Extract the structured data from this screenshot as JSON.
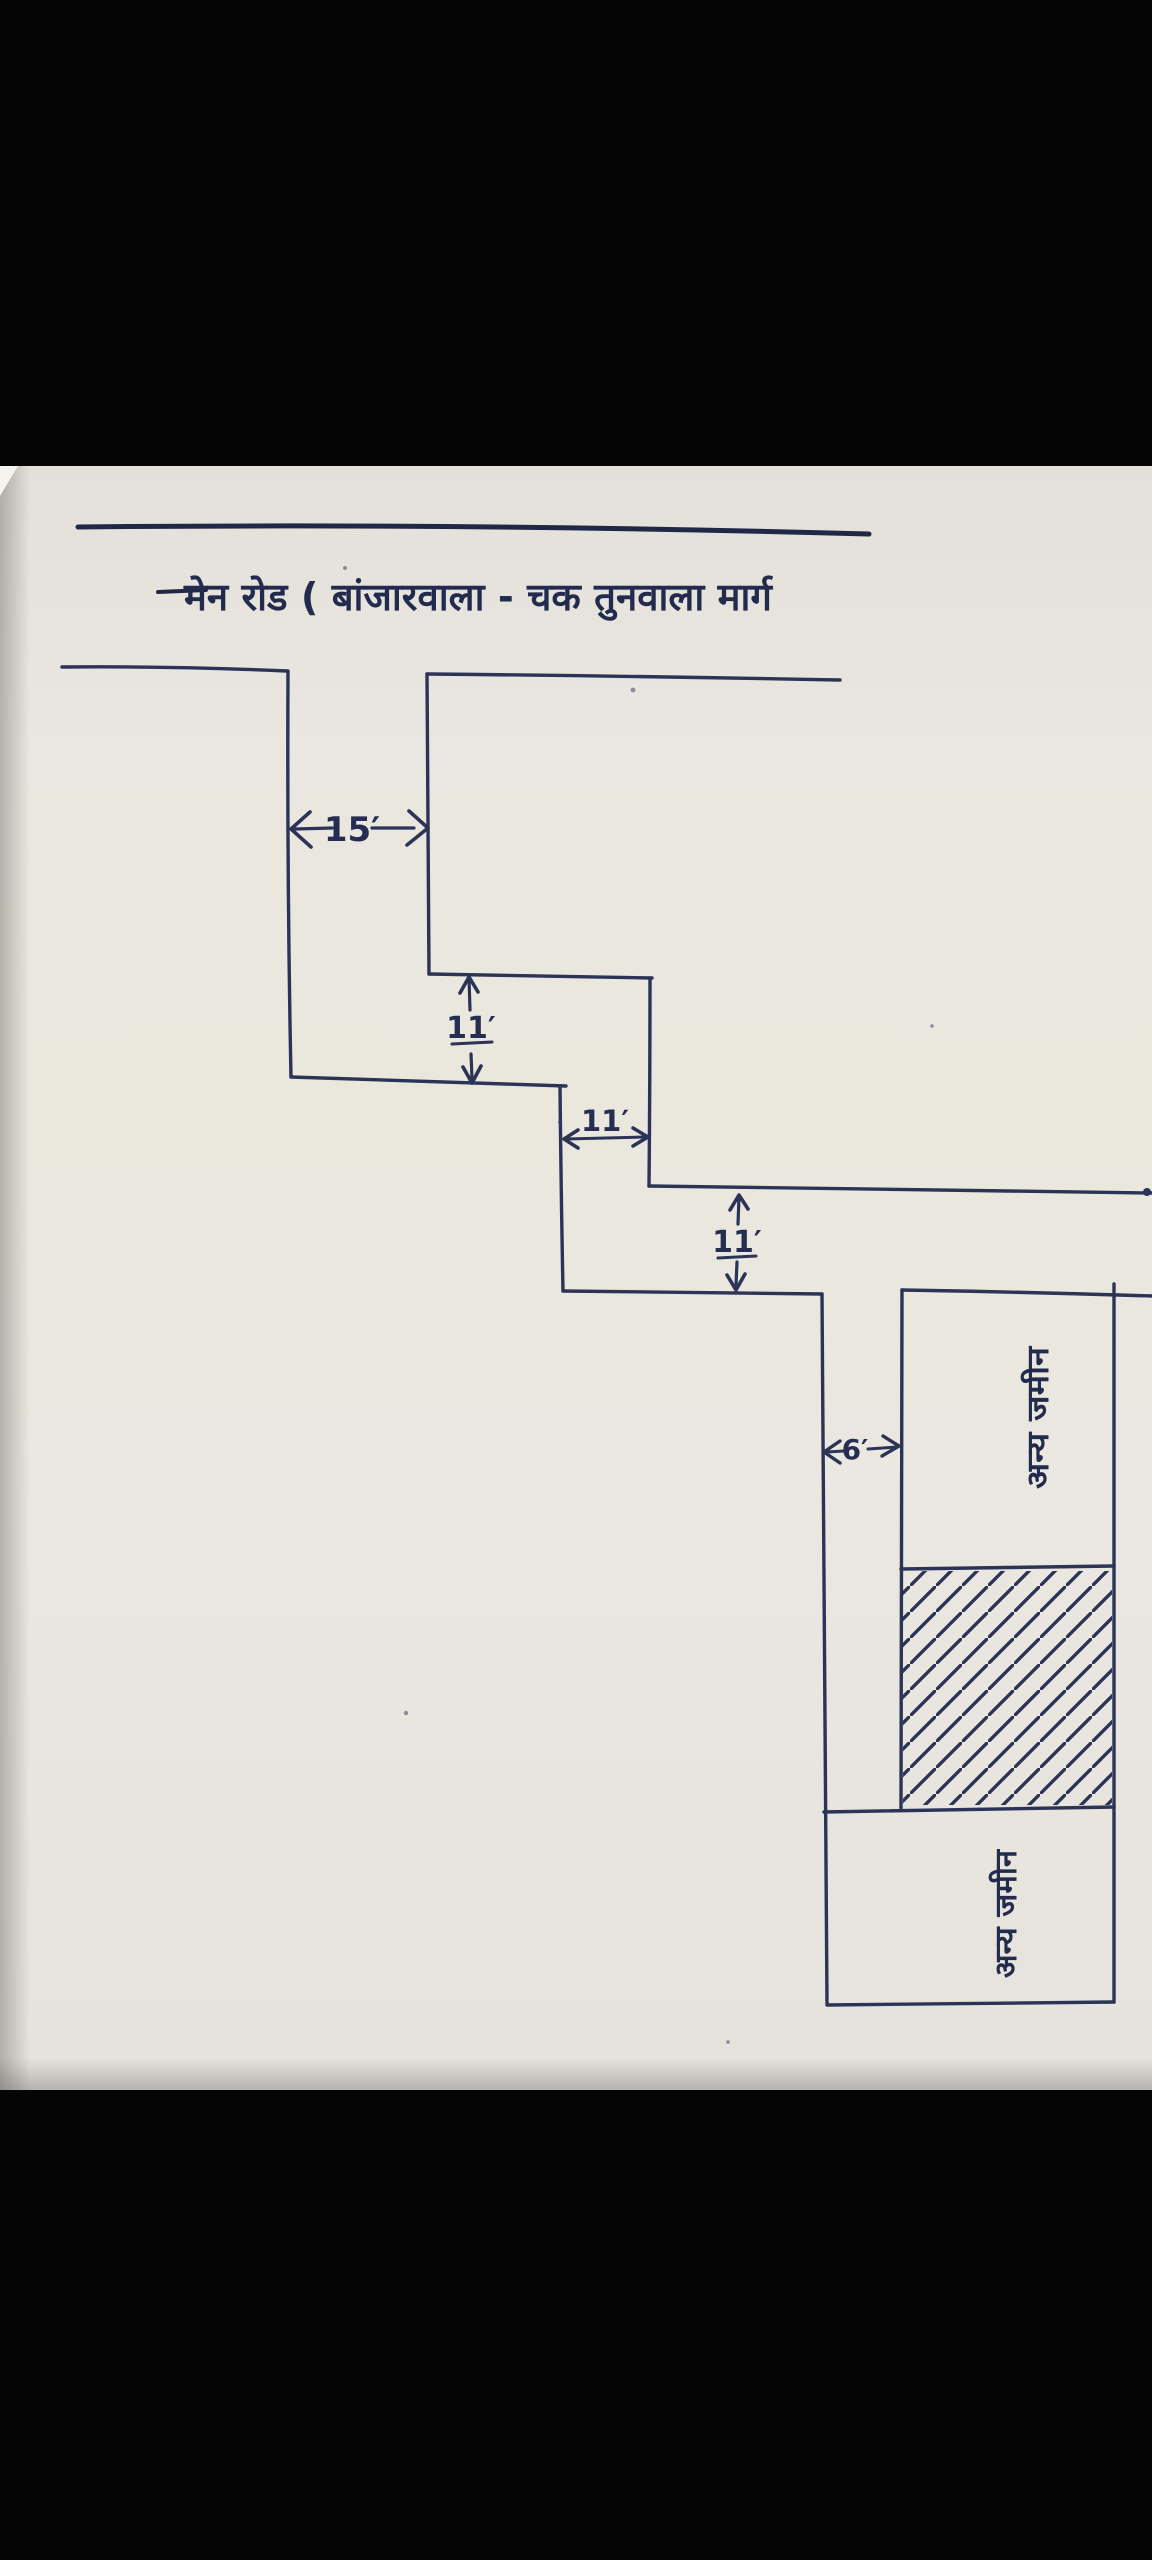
{
  "page": {
    "title_label": "मेन रोड ( बांजारवाला - चक तुनवाला मार्ग"
  },
  "dimensions": {
    "opening_width": "15′",
    "lane_height_1": "11′",
    "lane_width_2": "11′",
    "lane_height_3": "11′",
    "branch_width": "6′"
  },
  "plots": {
    "upper_label": "अन्य जमीन",
    "lower_label": "अन्य जमीन"
  },
  "colors": {
    "ink": "#2b3356",
    "ink_dark": "#1f2847",
    "paper": "#eae7e0",
    "frame": "#000000"
  }
}
